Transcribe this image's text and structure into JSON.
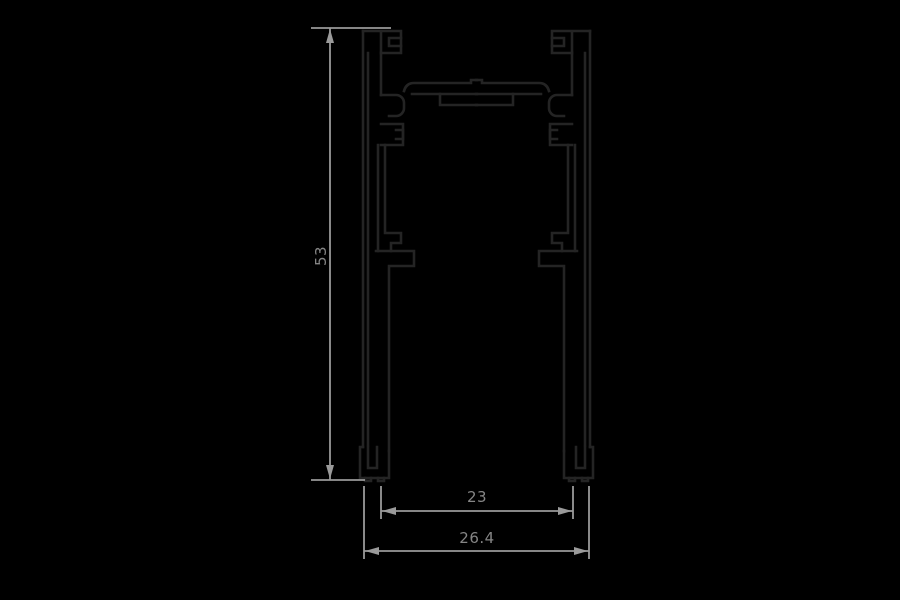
{
  "drawing": {
    "type": "technical cross-section drawing",
    "dimensions": {
      "height_label": "53",
      "inner_width_label": "23",
      "overall_width_label": "26.4"
    },
    "colors": {
      "background": "#000000",
      "profile_stroke": "#242424",
      "dimension_stroke": "#9a9a9a",
      "dimension_text": "#858585"
    }
  }
}
